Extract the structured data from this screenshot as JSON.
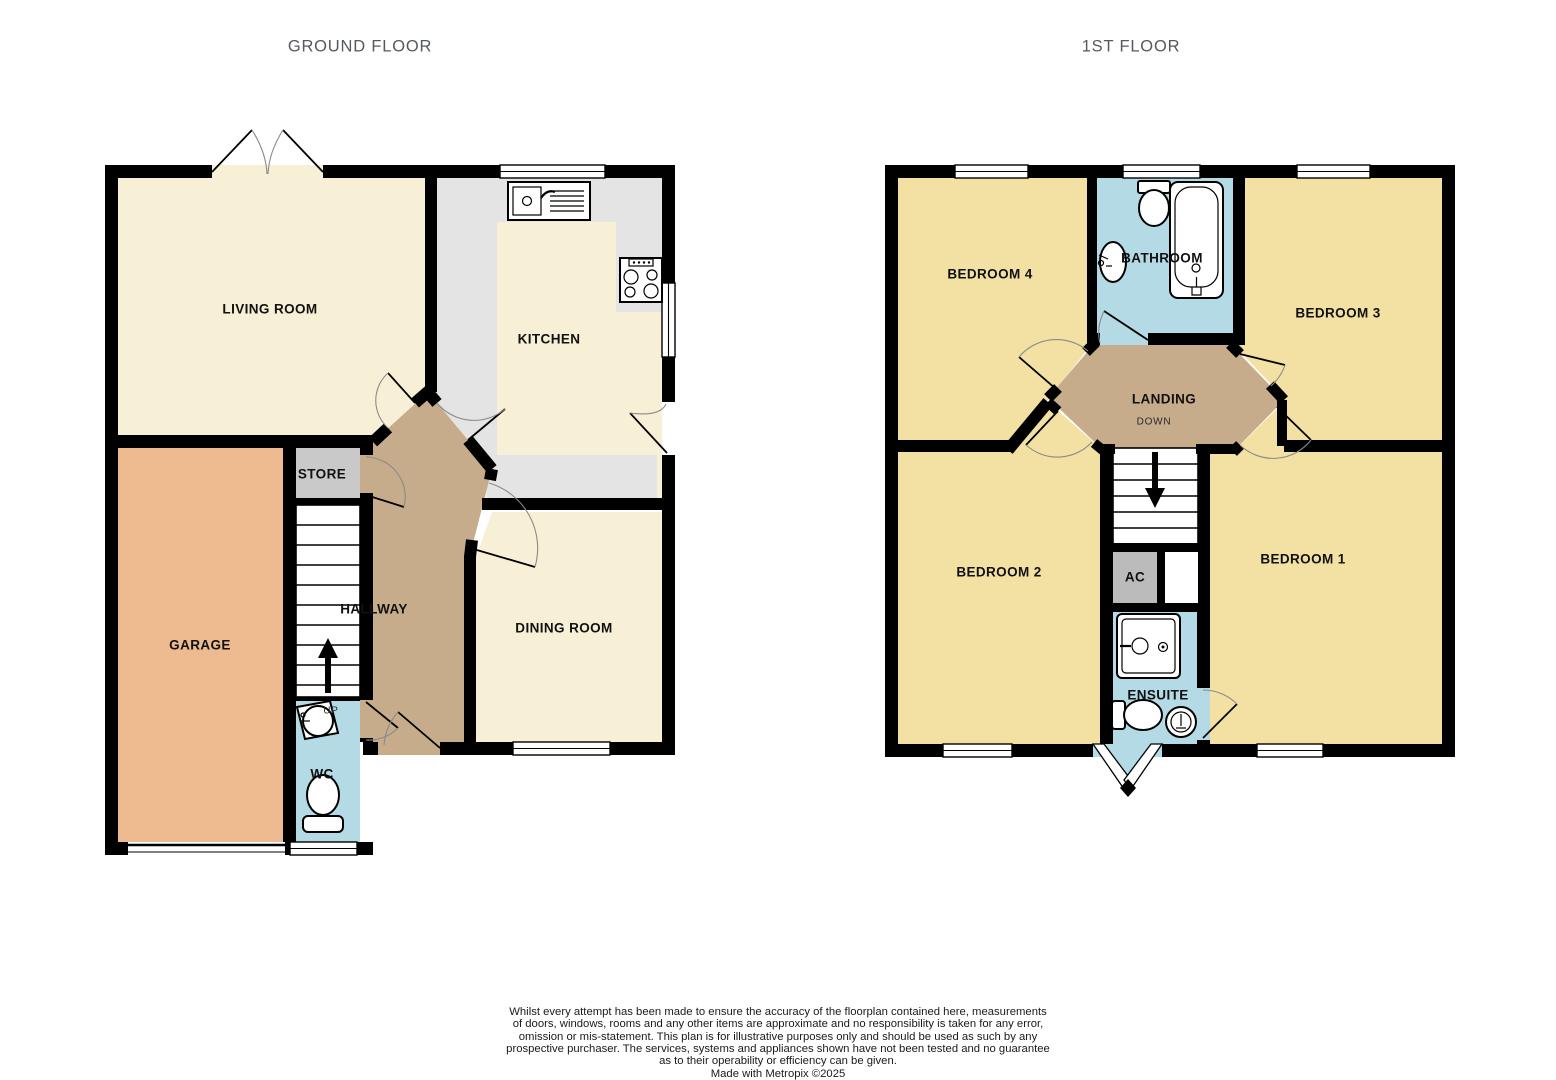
{
  "header": {
    "ground_floor_title": "GROUND FLOOR",
    "first_floor_title": "1ST FLOOR"
  },
  "ground_floor": {
    "rooms": {
      "living_room": "LIVING ROOM",
      "kitchen": "KITCHEN",
      "store": "STORE",
      "hallway": "HALLWAY",
      "garage": "GARAGE",
      "dining_room": "DINING ROOM",
      "wc": "WC"
    },
    "stairs_label": "UP"
  },
  "first_floor": {
    "rooms": {
      "bedroom4": "BEDROOM 4",
      "bathroom": "BATHROOM",
      "bedroom3": "BEDROOM 3",
      "landing": "LANDING",
      "bedroom2": "BEDROOM 2",
      "airing_cupboard": "AC",
      "bedroom1": "BEDROOM 1",
      "ensuite": "ENSUITE"
    },
    "stairs_label": "DOWN"
  },
  "footer": {
    "disclaimer_lines": [
      "Whilst every attempt has been made to ensure the accuracy of the floorplan contained here, measurements",
      "of doors, windows, rooms and any other items are approximate and no responsibility is taken for any error,",
      "omission or mis-statement. This plan is for illustrative purposes only and should be used as such by any",
      "prospective purchaser. The services, systems and appliances shown have not been tested and no guarantee",
      "as to their operability or efficiency can be given."
    ],
    "credit_line": "Made with Metropix ©2025"
  },
  "colors": {
    "bg": "#FFFFFF",
    "wall": "#000000",
    "cream": "#F7F0D6",
    "yellow": "#F3E1A4",
    "orange": "#EDBB8F",
    "tan": "#C6AC8A",
    "blue": "#B4DAE5",
    "store": "#C9C9C9",
    "counter": "#E4E4E4",
    "ac": "#BBBBBB",
    "title": "#555A60",
    "label": "#111111",
    "arc": "#8A8A8A"
  }
}
